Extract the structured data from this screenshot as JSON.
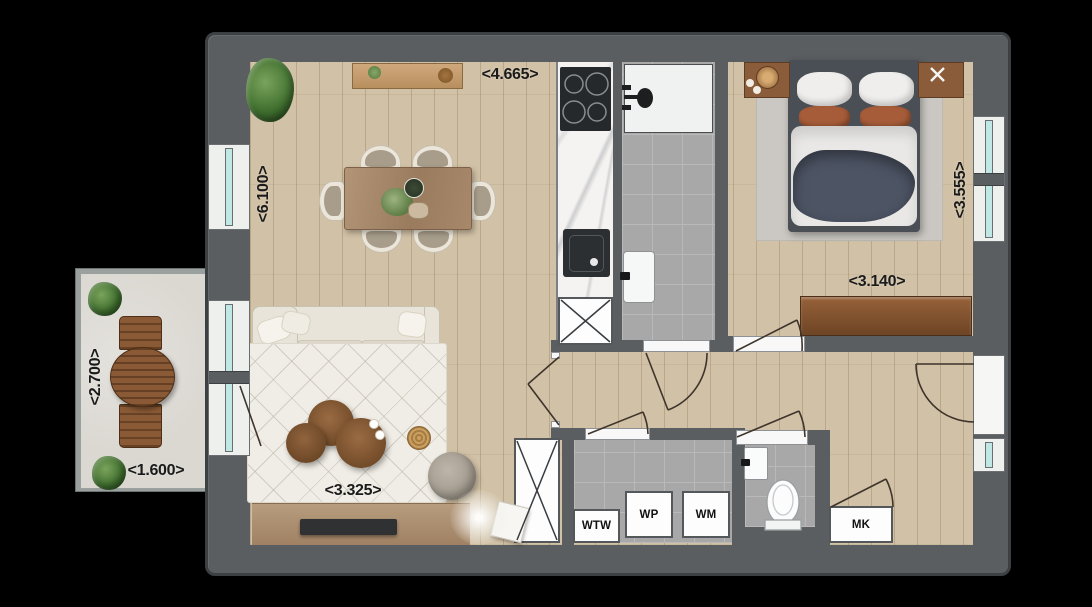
{
  "dimensions": {
    "dining_width": "<4.665>",
    "living_height": "<6.100>",
    "bedroom_height": "<3.555>",
    "bedroom_width": "<3.140>",
    "balcony_height": "<2.700>",
    "balcony_width": "<1.600>",
    "living_width": "<3.325>"
  },
  "labels": {
    "heat_recovery_unit": "WTW",
    "heat_pump": "WP",
    "washing_machine": "WM",
    "meter_cupboard": "MK"
  },
  "colors": {
    "background": "#000000",
    "wall": "#5a5e60",
    "wall_edge": "#3c4042",
    "wood_floor": "#d1c1a6",
    "tile_floor": "#a8a8a8",
    "tile_line": "#b9b9b9",
    "balcony_floor": "#dbd8d2",
    "glass": "#bfe7e3",
    "label_text": "#1a1a1a",
    "arc_line": "#3e342b"
  }
}
